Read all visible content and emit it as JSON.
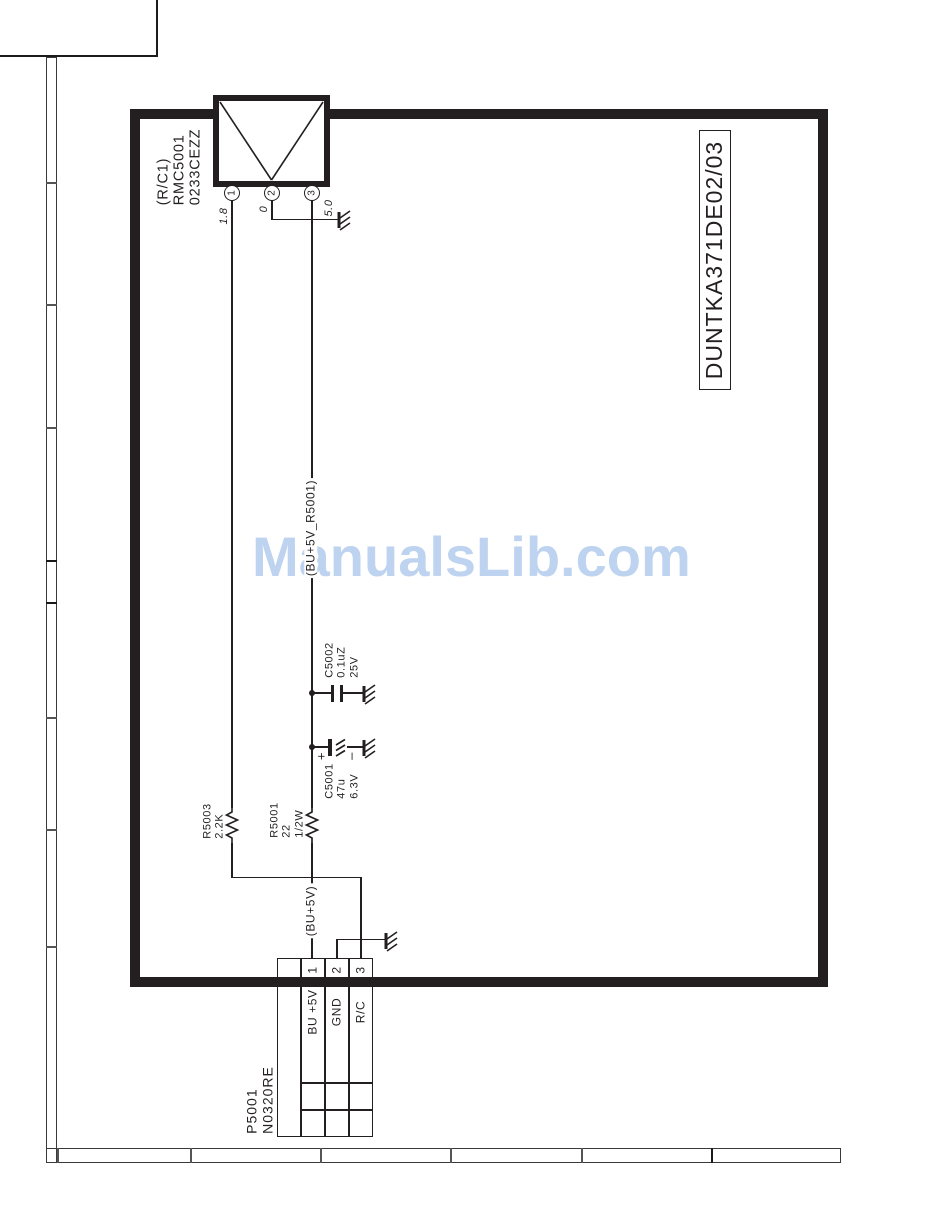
{
  "watermark": {
    "text": "ManualsLib.com",
    "color": "#bdd3ef"
  },
  "frame": {
    "board_code": "DUNTKA371DE02/03"
  },
  "receiver": {
    "ref_block": "(R/C1)\nRMC5001\n0233CEZZ",
    "pins": [
      {
        "number": "1",
        "voltage": "1.8"
      },
      {
        "number": "2",
        "voltage": "0"
      },
      {
        "number": "3",
        "voltage": "5.0"
      }
    ]
  },
  "components": {
    "c5002_label": "C5002\n0.1uZ\n25V",
    "c5001_label": "C5001\n47u\n6.3V",
    "c5001_plus": "+",
    "c5001_minus": "–",
    "r5003_label": "R5003\n2.2K",
    "r5001_label": "R5001\n22\n1/2W"
  },
  "nets": {
    "bu5v_r5001": "(BU+5V_R5001)",
    "bu5v": "(BU+5V)"
  },
  "connector": {
    "ref_block": "P5001\nN0320RE",
    "pins": [
      {
        "number": "1",
        "label": "BU +5V"
      },
      {
        "number": "2",
        "label": "GND"
      },
      {
        "number": "3",
        "label": "R/C"
      }
    ]
  }
}
